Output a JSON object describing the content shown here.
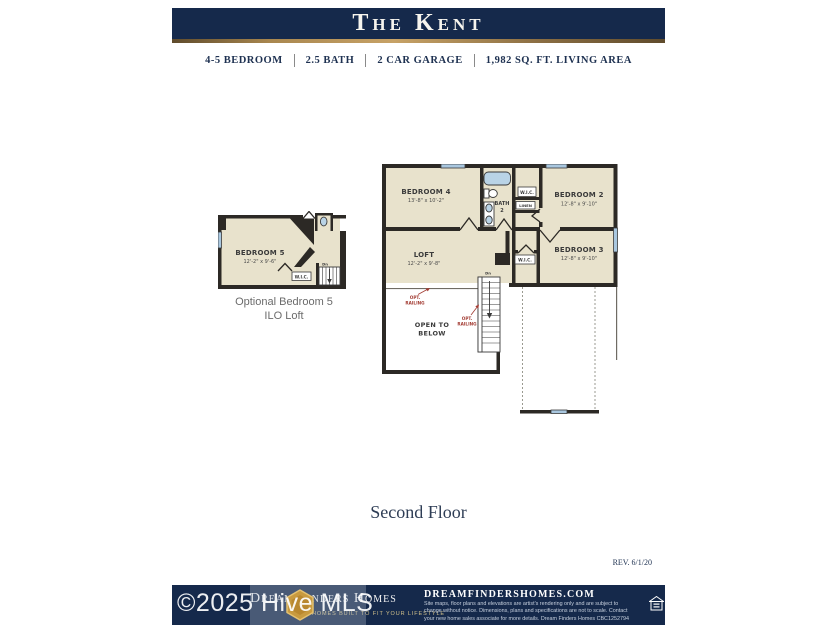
{
  "header": {
    "title": "The Kent"
  },
  "specs": [
    "4-5 BEDROOM",
    "2.5 BATH",
    "2 CAR GARAGE",
    "1,982 SQ. FT. LIVING AREA"
  ],
  "optional_plan": {
    "bedroom5_name": "BEDROOM 5",
    "bedroom5_dims": "12'-2\" x 9'-6\"",
    "wic": "W.I.C.",
    "stairs": "Dn",
    "caption_line1": "Optional Bedroom 5",
    "caption_line2": "ILO Loft"
  },
  "main_plan": {
    "bedroom4_name": "BEDROOM 4",
    "bedroom4_dims": "13'-8\" x 10'-2\"",
    "bath_name": "BATH",
    "bath_number": "2",
    "wic_top": "W.I.C.",
    "linen": "LINEN",
    "bedroom2_name": "BEDROOM 2",
    "bedroom2_dims": "12'-8\" x 9'-10\"",
    "loft_name": "LOFT",
    "loft_dims": "12'-2\" x 9'-8\"",
    "wic2": "W.I.C.",
    "bedroom3_name": "BEDROOM 3",
    "bedroom3_dims": "12'-8\" x 9'-10\"",
    "open_below_line1": "OPEN TO",
    "open_below_line2": "BELOW",
    "opt_railing_line1": "OPT.",
    "opt_railing_line2": "RAILING",
    "stairs": "Dn"
  },
  "floor_label": "Second Floor",
  "revision": "REV. 6/1/20",
  "watermark": "©2025 Hive MLS",
  "footer": {
    "brand": "Dream Finders Homes",
    "tagline": "HOMES BUILT TO FIT YOUR LIFESTYLE",
    "website": "DREAMFINDERSHOMES.COM",
    "disclaimer": "Site maps, floor plans and elevations are artist's rendering only and are subject to change without notice. Dimensions, plans and specifications are not to scale. Contact your new home sales associate for more details. Dream Finders Homes CBC1252794"
  },
  "colors": {
    "navy": "#15294b",
    "gold": "#c7a266",
    "floor_beige": "#e8e2cc",
    "wall": "#2c2925",
    "window_blue": "#a9c7df",
    "railing_red": "#a23b32"
  }
}
